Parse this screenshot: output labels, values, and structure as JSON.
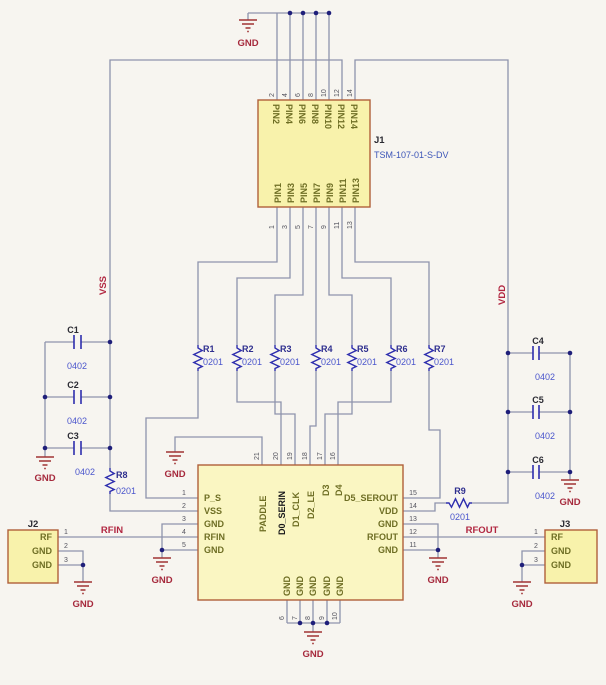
{
  "j1": {
    "ref": "J1",
    "part": "TSM-107-01-S-DV",
    "top_pins": [
      {
        "n": "2",
        "name": "PIN2"
      },
      {
        "n": "4",
        "name": "PIN4"
      },
      {
        "n": "6",
        "name": "PIN6"
      },
      {
        "n": "8",
        "name": "PIN8"
      },
      {
        "n": "10",
        "name": "PIN10"
      },
      {
        "n": "12",
        "name": "PIN12"
      },
      {
        "n": "14",
        "name": "PIN14"
      }
    ],
    "bottom_pins": [
      {
        "n": "1",
        "name": "PIN1"
      },
      {
        "n": "3",
        "name": "PIN3"
      },
      {
        "n": "5",
        "name": "PIN5"
      },
      {
        "n": "7",
        "name": "PIN7"
      },
      {
        "n": "9",
        "name": "PIN9"
      },
      {
        "n": "11",
        "name": "PIN11"
      },
      {
        "n": "13",
        "name": "PIN13"
      }
    ]
  },
  "ic": {
    "top_pins": [
      {
        "n": "21",
        "name": "PADDLE"
      },
      {
        "n": "20",
        "name": "D0_SERIN"
      },
      {
        "n": "19",
        "name": "D1_CLK"
      },
      {
        "n": "18",
        "name": "D2_LE"
      },
      {
        "n": "17",
        "name": "D3"
      },
      {
        "n": "16",
        "name": "D4"
      }
    ],
    "left_pins": [
      {
        "n": "1",
        "name": "P_S"
      },
      {
        "n": "2",
        "name": "VSS"
      },
      {
        "n": "3",
        "name": "GND"
      },
      {
        "n": "4",
        "name": "RFIN"
      },
      {
        "n": "5",
        "name": "GND"
      }
    ],
    "right_pins": [
      {
        "n": "15",
        "name": "D5_SEROUT"
      },
      {
        "n": "14",
        "name": "VDD"
      },
      {
        "n": "13",
        "name": "GND"
      },
      {
        "n": "12",
        "name": "RFOUT"
      },
      {
        "n": "11",
        "name": "GND"
      }
    ],
    "bottom_pins": [
      {
        "n": "6",
        "name": "GND"
      },
      {
        "n": "7",
        "name": "GND"
      },
      {
        "n": "8",
        "name": "GND"
      },
      {
        "n": "9",
        "name": "GND"
      },
      {
        "n": "10",
        "name": "GND"
      }
    ]
  },
  "j2": {
    "ref": "J2",
    "pins": [
      {
        "n": "1",
        "name": "RF"
      },
      {
        "n": "2",
        "name": "GND"
      },
      {
        "n": "3",
        "name": "GND"
      }
    ]
  },
  "j3": {
    "ref": "J3",
    "pins": [
      {
        "n": "1",
        "name": "RF"
      },
      {
        "n": "2",
        "name": "GND"
      },
      {
        "n": "3",
        "name": "GND"
      }
    ]
  },
  "resistors": [
    {
      "ref": "R1",
      "val": "0201"
    },
    {
      "ref": "R2",
      "val": "0201"
    },
    {
      "ref": "R3",
      "val": "0201"
    },
    {
      "ref": "R4",
      "val": "0201"
    },
    {
      "ref": "R5",
      "val": "0201"
    },
    {
      "ref": "R6",
      "val": "0201"
    },
    {
      "ref": "R7",
      "val": "0201"
    },
    {
      "ref": "R8",
      "val": "0201"
    },
    {
      "ref": "R9",
      "val": "0201"
    }
  ],
  "capacitors": [
    {
      "ref": "C1",
      "val": "0402"
    },
    {
      "ref": "C2",
      "val": "0402"
    },
    {
      "ref": "C3",
      "val": "0402"
    },
    {
      "ref": "C4",
      "val": "0402"
    },
    {
      "ref": "C5",
      "val": "0402"
    },
    {
      "ref": "C6",
      "val": "0402"
    }
  ],
  "nets": {
    "vss": "VSS",
    "vdd": "VDD",
    "rfin": "RFIN",
    "rfout": "RFOUT",
    "gnd": "GND"
  },
  "colors": {
    "wire": "#8e93ac",
    "symbol_blue": "#2e2eae",
    "ground_red": "#a03434",
    "net_label_red": "#b12640",
    "component_fill": "#f8f2ab",
    "component_border": "#b0603a",
    "part_number_blue": "#3c55b8",
    "pin_name_olive": "#6e6e24"
  }
}
